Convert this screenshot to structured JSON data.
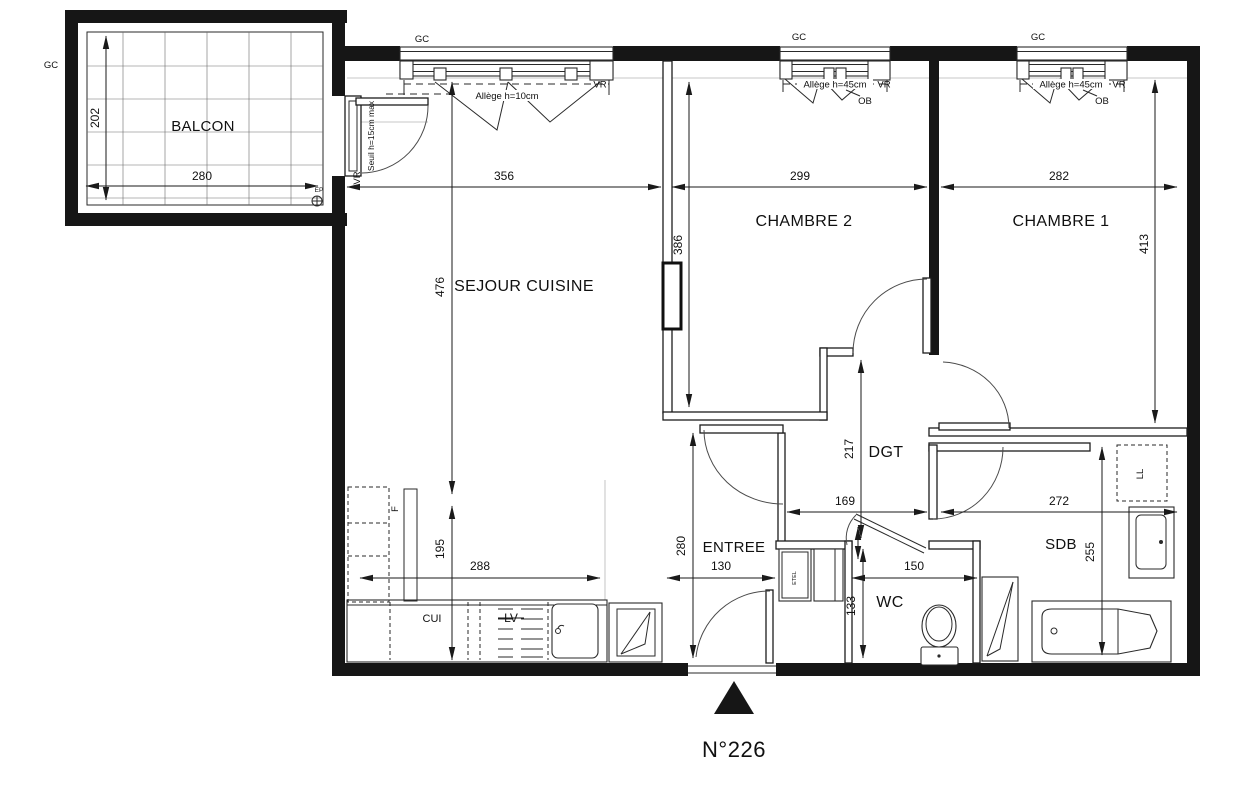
{
  "plan": {
    "number": "N°226",
    "rooms": {
      "balcon": "BALCON",
      "sejour": "SEJOUR CUISINE",
      "chambre2": "CHAMBRE 2",
      "chambre1": "CHAMBRE 1",
      "dgt": "DGT",
      "entree": "ENTREE",
      "wc": "WC",
      "sdb": "SDB",
      "cui": "CUI"
    },
    "dims": {
      "balcon_w": "280",
      "balcon_h": "202",
      "sejour_w": "356",
      "sejour_h": "476",
      "chambre2_w": "299",
      "chambre2_h": "386",
      "chambre1_w": "282",
      "chambre1_h": "413",
      "dgt_w": "169",
      "dgt_h": "217",
      "sdb_w": "272",
      "sdb_h": "255",
      "entree_w": "130",
      "entree_h": "280",
      "wc_w": "150",
      "wc_h": "133",
      "cuisine_w": "288",
      "cuisine_h": "195"
    },
    "annot": {
      "gc": "GC",
      "vr": "VR",
      "ob": "OB",
      "ep": "EP",
      "allege10": "Allège h=10cm",
      "allege45": "Allège h=45cm",
      "seuil": "Seuil h=15cm max",
      "frigo": "F",
      "lave_vaisselle": "LV",
      "lave_linge": "LL",
      "etel": "ETEL"
    },
    "colors": {
      "line": "#161616",
      "paper": "#ffffff"
    }
  }
}
